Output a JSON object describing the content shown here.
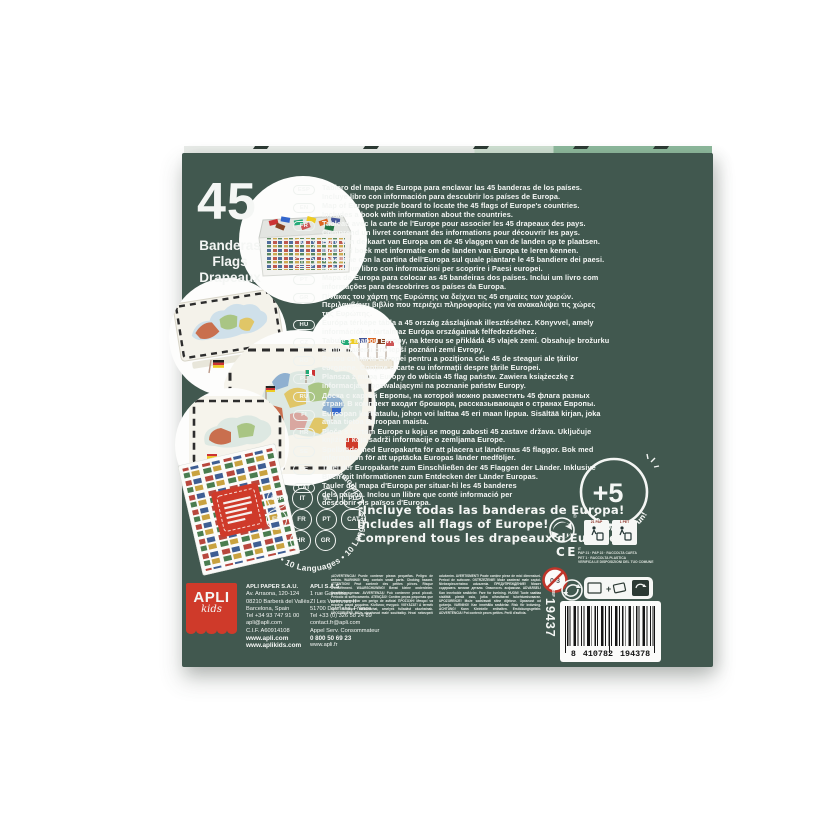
{
  "left_panel": {
    "count": "45",
    "names": [
      "Banderas",
      "Flags",
      "Drapeaux"
    ]
  },
  "chips": [
    "ESP",
    "IT",
    "NL",
    "PL",
    "EN",
    "FR",
    "PT",
    "CAT",
    "HR",
    "GR"
  ],
  "ring_text": "10 Idiomas • 10 Languages • 10 Langues • 10 Idiomas • 10 Languages •",
  "descriptions": [
    {
      "code": "ESP",
      "lines": [
        "Tablero del mapa de Europa para enclavar las 45 banderas de los países.",
        "Incluye libro con información para descubrir los países de Europa."
      ]
    },
    {
      "code": "EN",
      "lines": [
        "Map of Europe puzzle board to locate the 45 flags of Europe's countries.",
        "Includes a book with information about the countries."
      ]
    },
    {
      "code": "FR",
      "lines": [
        "Tableau avec la carte de l'Europe pour associer les 45 drapeaux des pays.",
        "Comprend un livret contenant des informations pour découvrir les pays."
      ]
    },
    {
      "code": "NL",
      "lines": [
        "Bord van de kaart van Europa om de 45 vlaggen van de landen op te plaatsen.",
        "Inclusief boek met informatie om de landen van Europa te leren kennen."
      ]
    },
    {
      "code": "IT",
      "lines": [
        "Tabellone con la cartina dell'Europa sul quale piantare le 45 bandiere dei paesi.",
        "Include un libro con informazioni per scoprire i Paesi europei."
      ]
    },
    {
      "code": "PT",
      "lines": [
        "Mapa da Europa para colocar as 45 bandeiras dos países. Inclui um livro com",
        "informações para descobrires os países da Europa."
      ]
    },
    {
      "code": "GR",
      "lines": [
        "Πίνακας του χάρτη της Ευρώπης να δείχνει τις 45 σημαίες των χωρών.",
        "Περιλαμβάνει βιβλίο που περιέχει πληροφορίες για να ανακαλύψει τις χώρες",
        "της Ευρώπης."
      ]
    },
    {
      "code": "HU",
      "lines": [
        "Európa térképe tábla a 45 ország zászlajának illesztéséhez. Könyvvel, amely",
        "információkat tartalmaz Európa országainak felfedezéséhez."
      ]
    },
    {
      "code": "CZ",
      "lines": [
        "Tabule s mapou Evropy, na kterou se přikládá 45 vlajek zemí. Obsahuje brožurku",
        "s informacemi pro lepší poznání zemí Evropy."
      ]
    },
    {
      "code": "RO",
      "lines": [
        "Panou cu harta Europei pentru a poziționa cele 45 de steaguri ale țărilor",
        "europene. Conține o carte cu informații despre țările Europei."
      ]
    },
    {
      "code": "PL",
      "lines": [
        "Plansza z mapą Europy do wbicia 45 flag państw. Zawiera książeczkę z",
        "informacjami pozwalającymi na poznanie państw Europy."
      ]
    },
    {
      "code": "RU",
      "lines": [
        "Доска с картой Европы, на которой можно разместить 45 флага разных",
        "стран. В комплект входит брошюра, рассказывающая о странах Европы."
      ]
    },
    {
      "code": "FI",
      "lines": [
        "Euroopan karttataulu, johon voi laittaa 45 eri maan lippua. Sisältää kirjan, joka",
        "antaa tietoa Euroopan maista."
      ]
    },
    {
      "code": "HR",
      "lines": [
        "Ploča s kartom Europe u koju se mogu zabosti 45 zastave država. Uključuje",
        "knjižicu koja sadrži informacije o zemljama Europe."
      ]
    },
    {
      "code": "SE",
      "lines": [
        "Spelbräde med Europakarta för att placera ut ländernas 45 flaggor. Bok med",
        "information för att upptäcka Europas länder medföljer."
      ]
    },
    {
      "code": "DE",
      "lines": [
        "Tafel der Europakarte zum Einschließen der 45 Flaggen der Länder. Inklusive",
        "Buch mit Informationen zum Entdecken der Länder Europas."
      ]
    },
    {
      "code": "CAT",
      "lines": [
        "Tauler del mapa d'Europa per situar-hi les 45 banderes",
        "dels països. Inclou un llibre que conté informació per",
        "descobrir els països d'Europa."
      ]
    }
  ],
  "claims": {
    "line1": "¡Incluye todas las banderas de Europa!",
    "line2": "Includes all flags of Europe!",
    "line3": "Comprend tous les drapeaux d'Europe!"
  },
  "badge": {
    "age": "+5",
    "tagline": "Learning is Fun!"
  },
  "logo": {
    "brand": "APLI",
    "sub": "kids"
  },
  "addresses": {
    "spain": {
      "lines": [
        "APLI PAPER S.A.U.",
        "Av. Arraona, 120-124",
        "08210 Barberà del Vallès",
        "Barcelona, Spain",
        "Tel +34 93 747 91 00",
        "apli@apli.com",
        "C.I.F. A60914108",
        "www.apli.com",
        "www.aplikids.com"
      ]
    },
    "france": {
      "lines": [
        "APLI S.A.S",
        "1 rue Garenne",
        "ZI Les Varennes II",
        "51700 Dormans, France",
        "Tel +33 (0) 326 58 24 89",
        "contact.fr@apli.com",
        "Appel Serv. Consommateur",
        "0 800 50 69 23",
        "www.apli.fr"
      ]
    }
  },
  "warning": {
    "text": "¡ADVERTENCIA! Puede contener piezas pequeñas. Peligro de asfixia. WARNING! May contain small parts. Choking hazard. ATTENTION! Peut contenir des petites pièces. Risque d'étouffement. WAARSCHUWING! Bevat kleine onderdelen. Verstikkingsgevaar. AVVERTENZA! Può contenere pezzi piccoli. Pericolo di soffocamento. ATENÇÃO! Contém peças pequenas que podem representar um perigo de asfixia! ΠΡΟΣΟΧΗ! Μπορεί να περιέχει μικρά κομμάτια. Κίνδυνος πνιγμού. VIGYÁZAT! A termék apró elemeket tartalmazhat, amelyek fulladást okozhatnak. UPOZORNĚNÍ! Může obsahovat malé součástky. Hrozí nebezpečí udušením. AVERTISMENT! Poate conține piese de mici dimensiuni. Pericol de sufocare. OSTRZEŻENIE! Może zawierać małe części. Niebezpieczeństwo uduszenia. ПРЕДУПРЕЖДЕНИЕ! Может содержать мелкие детали. Опасность асфиксии. ADVARSEL! Kan inneholde smådeler. Fare for kvelning. HUOM! Tuote saattaa sisältää pieniä osia, jotka aiheuttavat tukehtumisvaaran. UPOZORENJE! Može sadržavati sitne dijelove. Opasnost od gušenja. VARNING! Kan innehålla smådelar. Risk för kvävning. ACHTUNG! Kann Kleinteile enthalten. Erstickungsgefahr. ADVERTÈNCIA! Pot contenir peces petites. Perill d'asfíxia."
  },
  "recycling": {
    "ce": "CE",
    "registered": "®",
    "labels": [
      "21 PAP",
      "1 PET"
    ],
    "it_disposal": [
      "IT",
      "PAP 21 · PAP 22 · RACCOLTA CARTA",
      "PET 1 · RACCOLTA PLASTICA",
      "VERIFICA LE DISPOSIZIONI DEL TUO COMUNE"
    ]
  },
  "age_warning": {
    "range": "0-3"
  },
  "ref": {
    "label": "REF",
    "number": "19437"
  },
  "barcode": {
    "left": "8",
    "mid": "410782",
    "right": "194378"
  }
}
